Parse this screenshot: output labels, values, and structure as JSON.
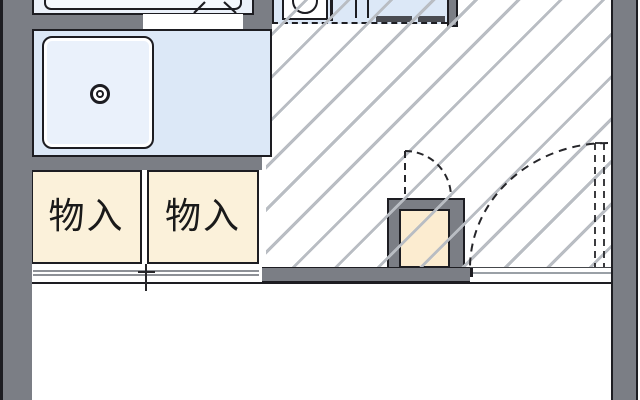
{
  "meta": {
    "type": "floor-plan",
    "description": "partial Japanese apartment floor plan, cropped top and bottom"
  },
  "closets": {
    "left": {
      "label": "物入"
    },
    "right": {
      "label": "物入"
    }
  },
  "fixtures": [
    "bathtub",
    "bathroom-folding-door",
    "washing-machine-pan",
    "drain",
    "kitchen-sink",
    "stove-burners",
    "water-heater-box",
    "storage-closet-sliding-doors",
    "entry-door-swing-large",
    "door-swing-small"
  ],
  "colors": {
    "wall_gray": "#7b7e85",
    "outline_black": "#1d1d22",
    "water_area_blue": "#dce8f7",
    "pan_blue": "#eaf1fb",
    "closet_cream": "#fbf1da",
    "heater_cream": "#fcecd0",
    "hatch_line_gray": "#b9bdc3",
    "floor_white": "#ffffff",
    "bathroom_blue": "#ebf1fa"
  }
}
